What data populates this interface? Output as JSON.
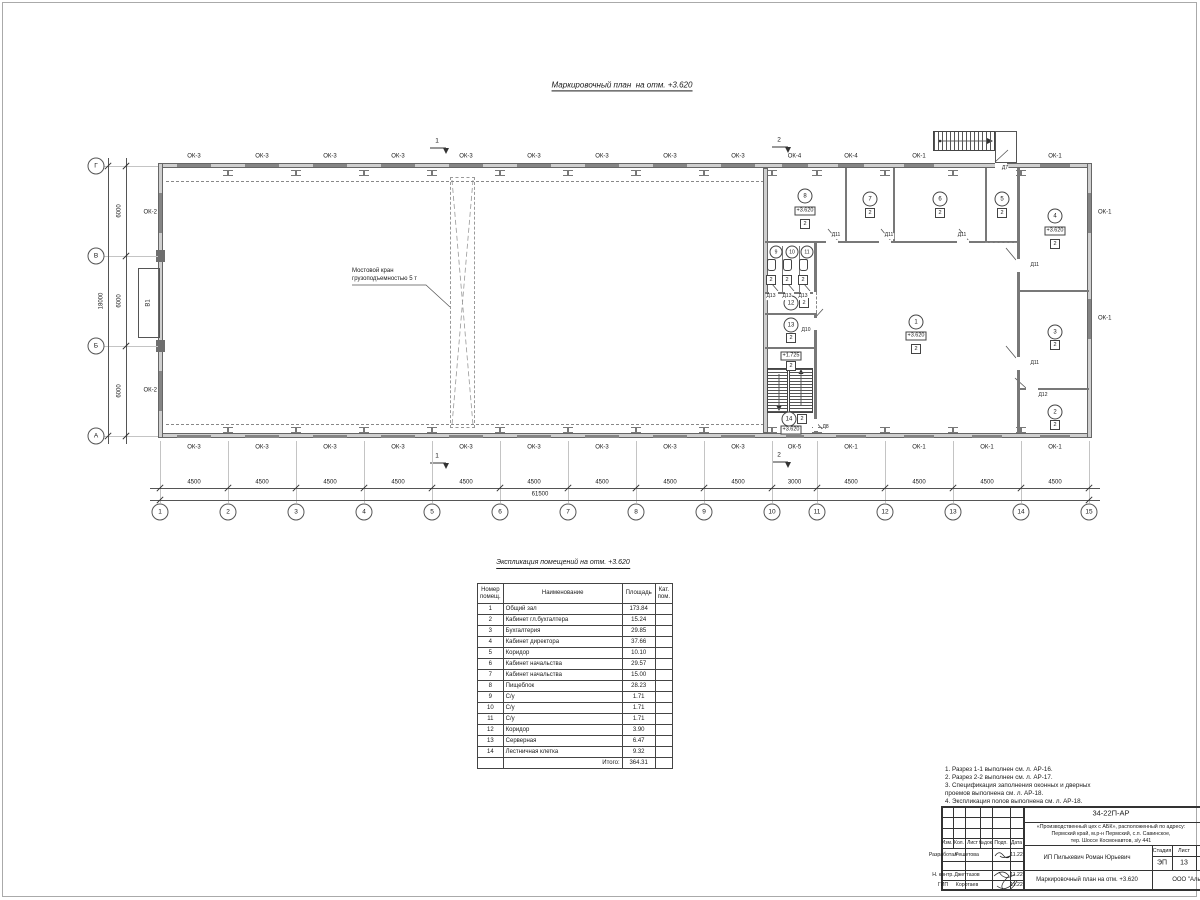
{
  "title": "Маркировочный план  на отм. +3.620",
  "plan": {
    "crane_label": "Мостовой кран\nгрузоподъемностью 5 т",
    "riser_label": "В1",
    "cols": [
      "1",
      "2",
      "3",
      "4",
      "5",
      "6",
      "7",
      "8",
      "9",
      "10",
      "11",
      "12",
      "13",
      "14",
      "15"
    ],
    "rows": [
      "Г",
      "В",
      "Б",
      "А"
    ],
    "bay_dims": [
      "4500",
      "4500",
      "4500",
      "4500",
      "4500",
      "4500",
      "4500",
      "4500",
      "4500",
      "3000",
      "4500",
      "4500",
      "4500",
      "4500"
    ],
    "total_dim": "61500",
    "row_dims": [
      "6000",
      "6000",
      "6000"
    ],
    "row_total": "18000",
    "windows_top": [
      "ОК-3",
      "ОК-3",
      "ОК-3",
      "ОК-3",
      "ОК-3",
      "ОК-3",
      "ОК-3",
      "ОК-3",
      "ОК-3",
      "ОК-4",
      "ОК-4",
      "ОК-1",
      "",
      "ОК-1"
    ],
    "windows_bottom": [
      "ОК-3",
      "ОК-3",
      "ОК-3",
      "ОК-3",
      "ОК-3",
      "ОК-3",
      "ОК-3",
      "ОК-3",
      "ОК-3",
      "ОК-5",
      "ОК-1",
      "ОК-1",
      "ОК-1",
      "ОК-1"
    ],
    "windows_left": [
      "ОК-2",
      "ОК-2"
    ],
    "windows_right": [
      "ОК-1",
      "ОК-1"
    ],
    "section_marks": [
      "1",
      "2"
    ],
    "rooms": [
      {
        "n": "1",
        "level": "+3.620",
        "cat": "2"
      },
      {
        "n": "2",
        "cat": "2"
      },
      {
        "n": "3",
        "cat": "2"
      },
      {
        "n": "4",
        "level": "+3.620",
        "cat": "2"
      },
      {
        "n": "5",
        "cat": "2"
      },
      {
        "n": "6",
        "cat": "2"
      },
      {
        "n": "7",
        "cat": "2"
      },
      {
        "n": "8",
        "level": "+3.620",
        "cat": "2"
      },
      {
        "n": "9"
      },
      {
        "n": "10"
      },
      {
        "n": "11"
      },
      {
        "n": "12",
        "cat": "2"
      },
      {
        "n": "13",
        "cat": "2"
      },
      {
        "n": "14",
        "level": "+3.620",
        "cat": "2"
      }
    ],
    "landing_level": "+1.725",
    "landing_cat": "2",
    "toilet_cats": [
      "2",
      "2",
      "2"
    ],
    "door_labels": [
      "Д11",
      "Д11",
      "Д11",
      "Д11",
      "Д11",
      "Д12",
      "Д10",
      "Д13",
      "Д13",
      "Д13",
      "Д8",
      "Д7"
    ]
  },
  "explication": {
    "title": "Экспликация помещений на отм. +3.620",
    "headers": [
      "Номер\nпомещ.",
      "Наименование",
      "Площадь",
      "Кат.\nпом."
    ],
    "rows": [
      [
        "1",
        "Общий зал",
        "173.84"
      ],
      [
        "2",
        "Кабинет гл.бухгалтера",
        "15.24"
      ],
      [
        "3",
        "Бухгалтерия",
        "29.85"
      ],
      [
        "4",
        "Кабинет директора",
        "37.66"
      ],
      [
        "5",
        "Коридор",
        "10.10"
      ],
      [
        "6",
        "Кабинет начальства",
        "29.57"
      ],
      [
        "7",
        "Кабинет начальства",
        "15.00"
      ],
      [
        "8",
        "Пищеблок",
        "28.23"
      ],
      [
        "9",
        "С/у",
        "1.71"
      ],
      [
        "10",
        "С/у",
        "1.71"
      ],
      [
        "11",
        "С/у",
        "1.71"
      ],
      [
        "12",
        "Коридор",
        "3.90"
      ],
      [
        "13",
        "Серверная",
        "6.47"
      ],
      [
        "14",
        "Лестничная клетка",
        "9.32"
      ]
    ],
    "total_label": "Итого:",
    "total": "364.31"
  },
  "notes": [
    "1. Разрез 1-1 выполнен см. л. АР-16.",
    "2. Разрез 2-2 выполнен см. л. АР-17.",
    "3. Спецификация заполнения оконных и дверных\n    проемов выполнена см. л. АР-18.",
    "4. Экспликация полов выполнена см. л. АР-18."
  ],
  "titleblock": {
    "doc_number": "34-22П-АР",
    "address_lines": [
      "«Производственный цех с АБК», расположенный по адресу:",
      "Пермский край, м.р-н Пермский, с.п. Савинское,",
      "тер. Шоссе Космонавтов, з/у 441"
    ],
    "grid_headers": [
      "Изм.",
      "Кол.",
      "Лист",
      "№док.",
      "Подп.",
      "Дата"
    ],
    "roles": [
      {
        "role": "Разработал",
        "name": "Решетова",
        "date": "11.22"
      },
      {
        "role": "Н. контр.",
        "name": "Джеттазов",
        "date": "11.22"
      },
      {
        "role": "ГИП",
        "name": "Коротаев",
        "date": "11.22"
      }
    ],
    "client": "ИП Пилькевич Роман Юрьевич",
    "stage_label": "Стадия",
    "sheet_label": "Лист",
    "sheets_label": "Листов",
    "stage": "ЭП",
    "sheet": "13",
    "drawing_title": "Маркировочный план на отм. +3.620",
    "org": "ООО \"Алы"
  }
}
